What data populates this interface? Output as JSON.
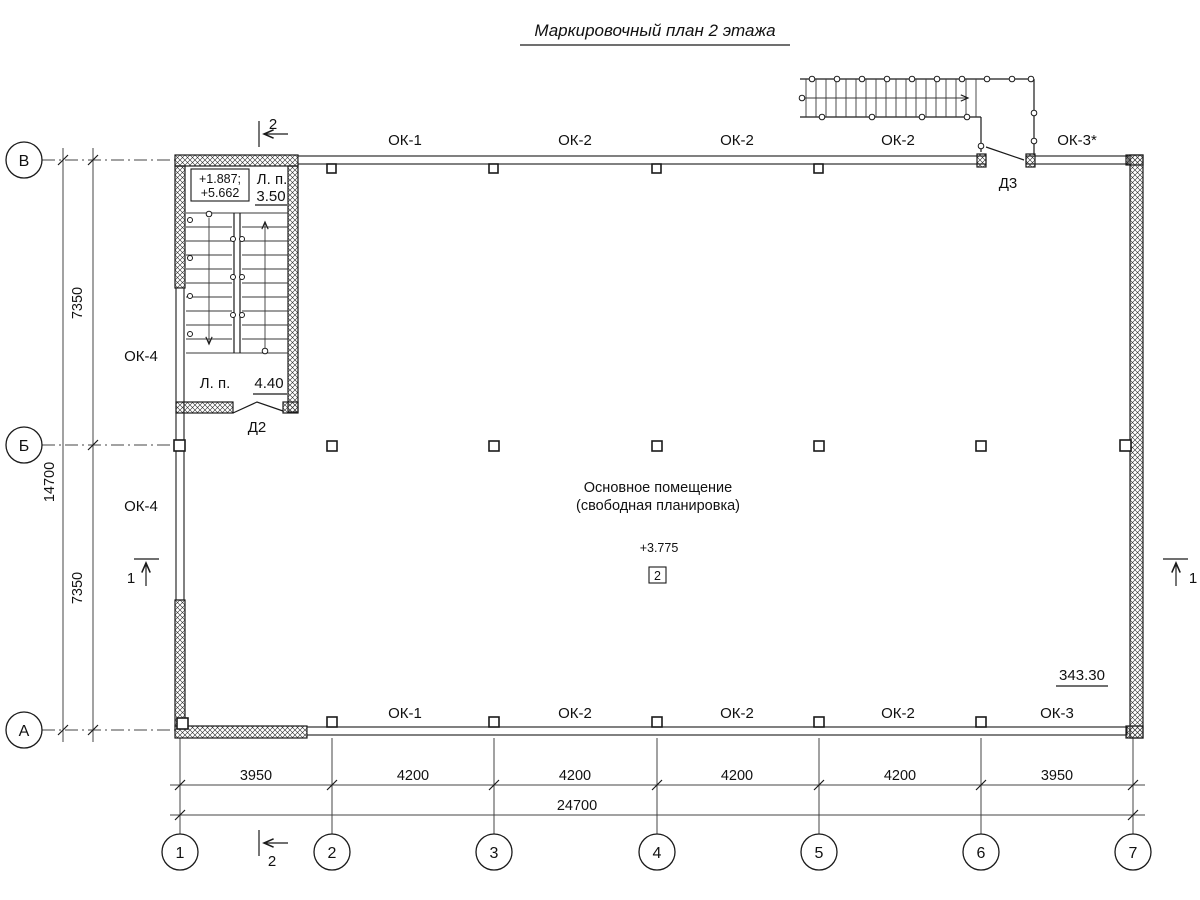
{
  "title": "Маркировочный план 2 этажа",
  "grid": {
    "rows": [
      "В",
      "Б",
      "А"
    ],
    "cols": [
      "1",
      "2",
      "3",
      "4",
      "5",
      "6",
      "7"
    ]
  },
  "dims": {
    "left_total": "14700",
    "left_segments": [
      "7350",
      "7350"
    ],
    "bottom_segments": [
      "3950",
      "4200",
      "4200",
      "4200",
      "4200",
      "3950"
    ],
    "bottom_total": "24700"
  },
  "windows": {
    "top": [
      "ОК-1",
      "ОК-2",
      "ОК-2",
      "ОК-2",
      "ОК-3*"
    ],
    "bottom": [
      "ОК-1",
      "ОК-2",
      "ОК-2",
      "ОК-2",
      "ОК-3"
    ],
    "left": [
      "ОК-4",
      "ОК-4"
    ]
  },
  "doors": {
    "d2": "Д2",
    "d3": "Д3"
  },
  "stairs": {
    "level_line1": "+1.887;",
    "level_line2": "+5.662",
    "upper_label": "Л. п.",
    "upper_value": "3.50",
    "lower_label": "Л. п.",
    "lower_value": "4.40"
  },
  "room": {
    "name": "Основное помещение",
    "name2": "(свободная планировка)",
    "level": "+3.775",
    "number": "2",
    "area": "343.30"
  },
  "sections": {
    "one": "1",
    "two": "2"
  },
  "colors": {
    "line": "#1a1a1a",
    "background": "#ffffff"
  }
}
